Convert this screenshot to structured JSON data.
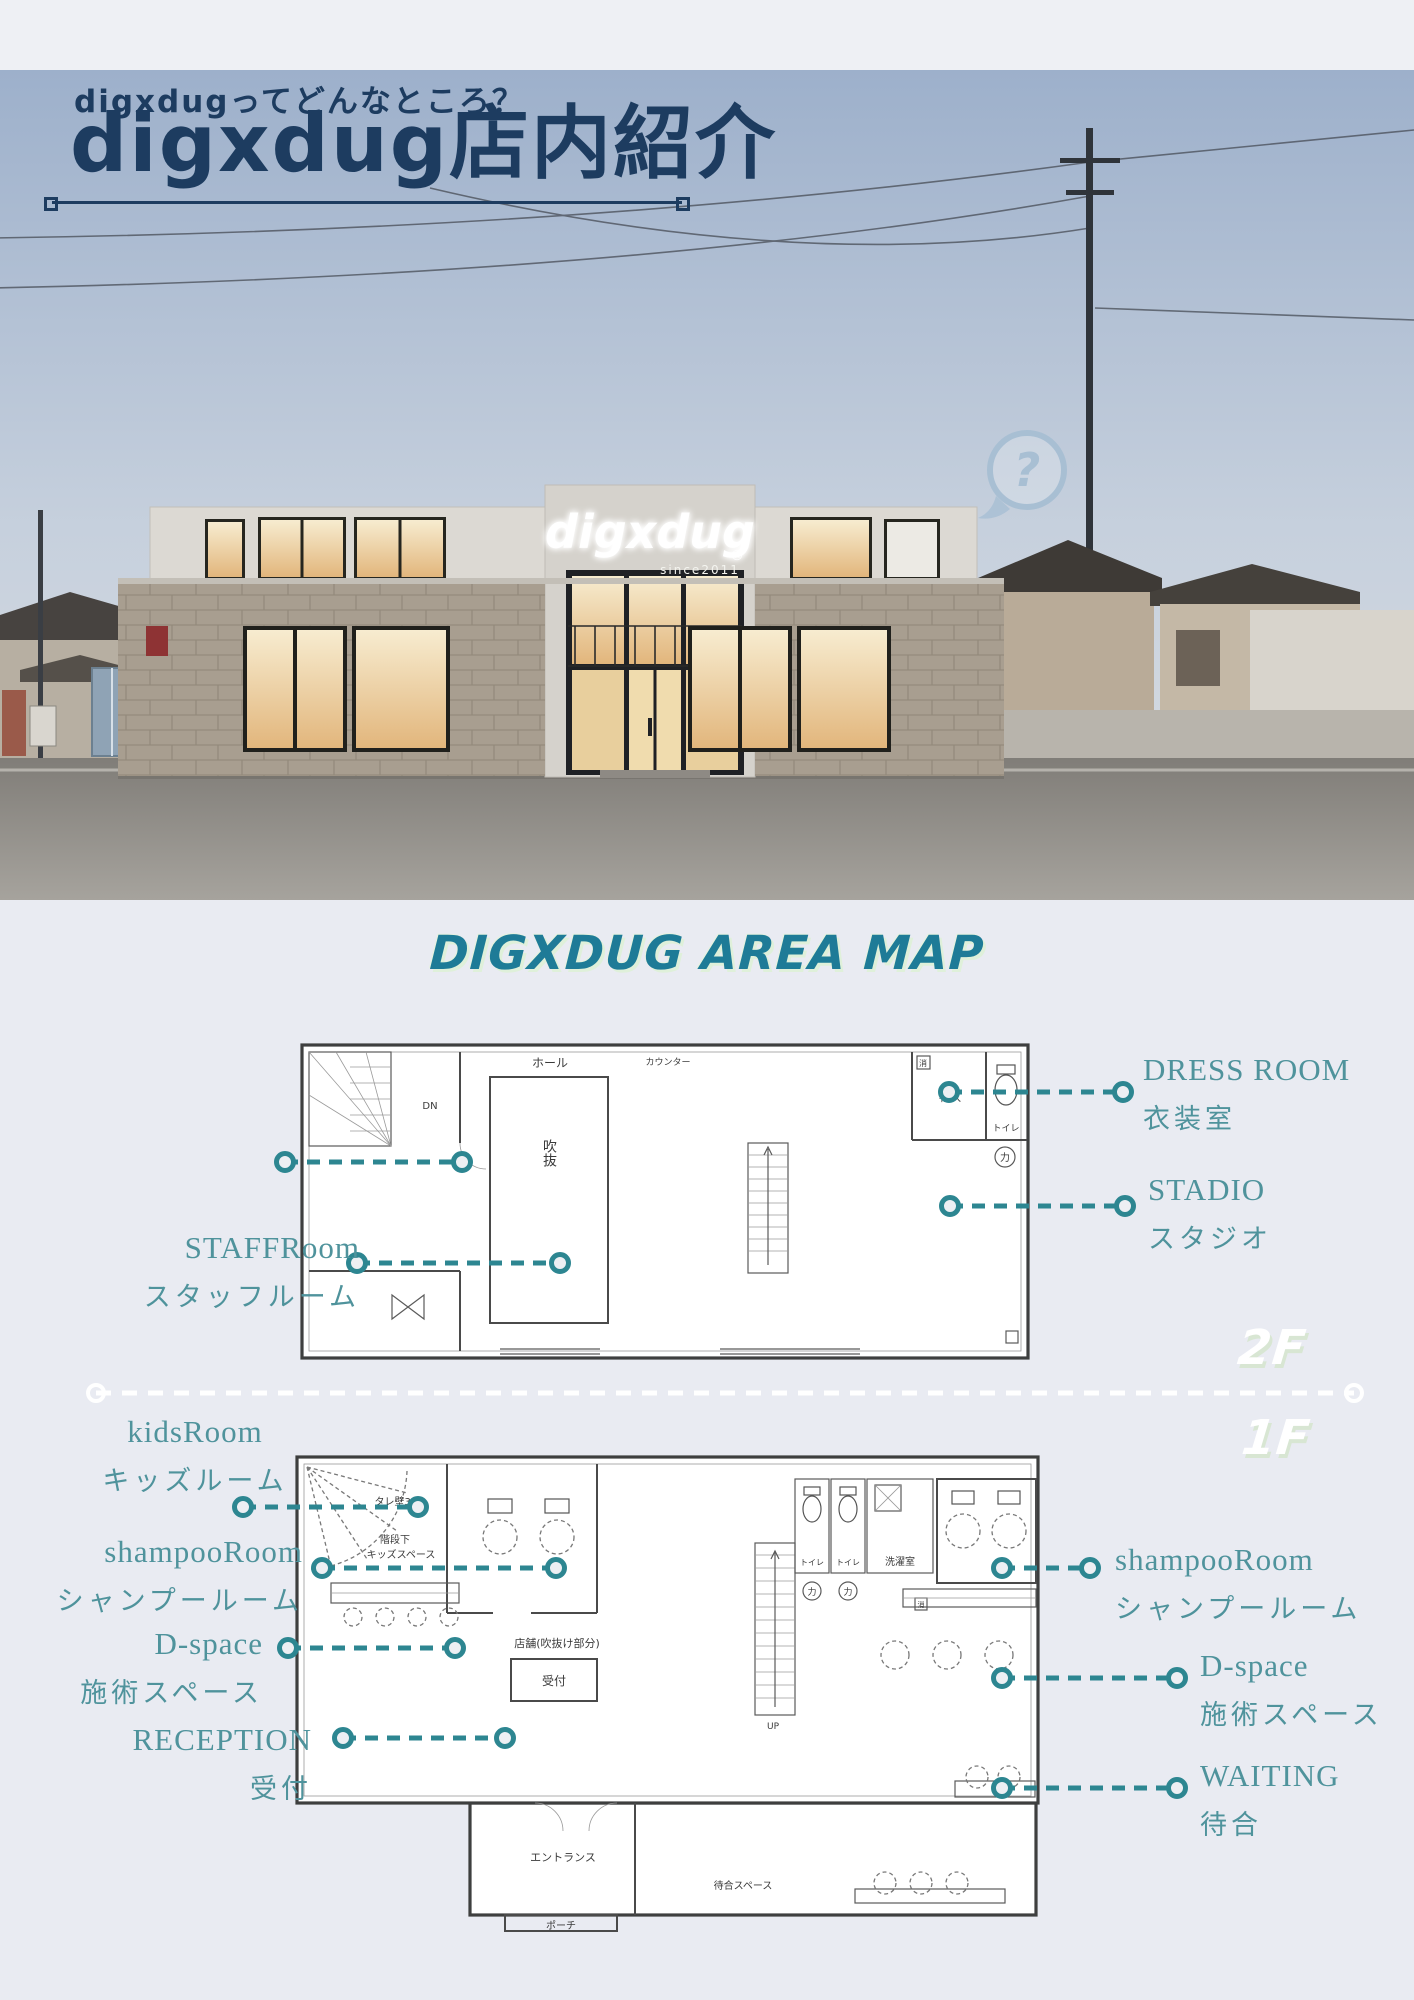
{
  "colors": {
    "navy": "#1d3c60",
    "teal_label_text": "#4f939c",
    "teal_leader": "#2d8691",
    "map_title": "#1e7b97",
    "title_shadow": "#dff0da",
    "background": "#e9ebf2",
    "floor_badge": "#ffffff"
  },
  "header": {
    "subtitle": "digxdugってどんなところ？",
    "title": "digxdug店内紹介"
  },
  "photo": {
    "logo": "digxdug",
    "reg": "®",
    "since": "since2011",
    "help": "?"
  },
  "area_map": {
    "title": "DIGXDUG AREA MAP"
  },
  "floors": {
    "f2": {
      "badge": "2F",
      "plan": {
        "hall": "ホール",
        "counter": "カウンター",
        "void": "吹抜",
        "dn": "DN",
        "storage": "物入",
        "toilet": "トイレ",
        "riki": "力",
        "sho": "消"
      },
      "labels": {
        "staff": {
          "en": "STAFFRoom",
          "jp": "スタッフルーム"
        },
        "dress": {
          "en": "DRESS ROOM",
          "jp": "衣装室"
        },
        "stadio": {
          "en": "STADIO",
          "jp": "スタジオ"
        }
      }
    },
    "f1": {
      "badge": "1F",
      "plan": {
        "tare": "タレ壁300",
        "under": "階段下",
        "kids": "キッズスペース",
        "laundry": "洗濯室",
        "toilet": "トイレ",
        "riki": "力",
        "shop": "店舗(吹抜け部分)",
        "reception": "受付",
        "entrance": "エントランス",
        "porch": "ポーチ",
        "waiting": "待合スペース",
        "up": "UP",
        "sho": "消"
      },
      "labels": {
        "kids": {
          "en": "kidsRoom",
          "jp": "キッズルーム"
        },
        "shampoo_left": {
          "en": "shampooRoom",
          "jp": "シャンプールーム"
        },
        "dspace_left": {
          "en": "D-space",
          "jp": "施術スペース"
        },
        "reception": {
          "en": "RECEPTION",
          "jp": "受付"
        },
        "shampoo_right": {
          "en": "shampooRoom",
          "jp": "シャンプールーム"
        },
        "dspace_right": {
          "en": "D-space",
          "jp": "施術スペース"
        },
        "waiting": {
          "en": "WAITING",
          "jp": "待合"
        }
      }
    }
  }
}
